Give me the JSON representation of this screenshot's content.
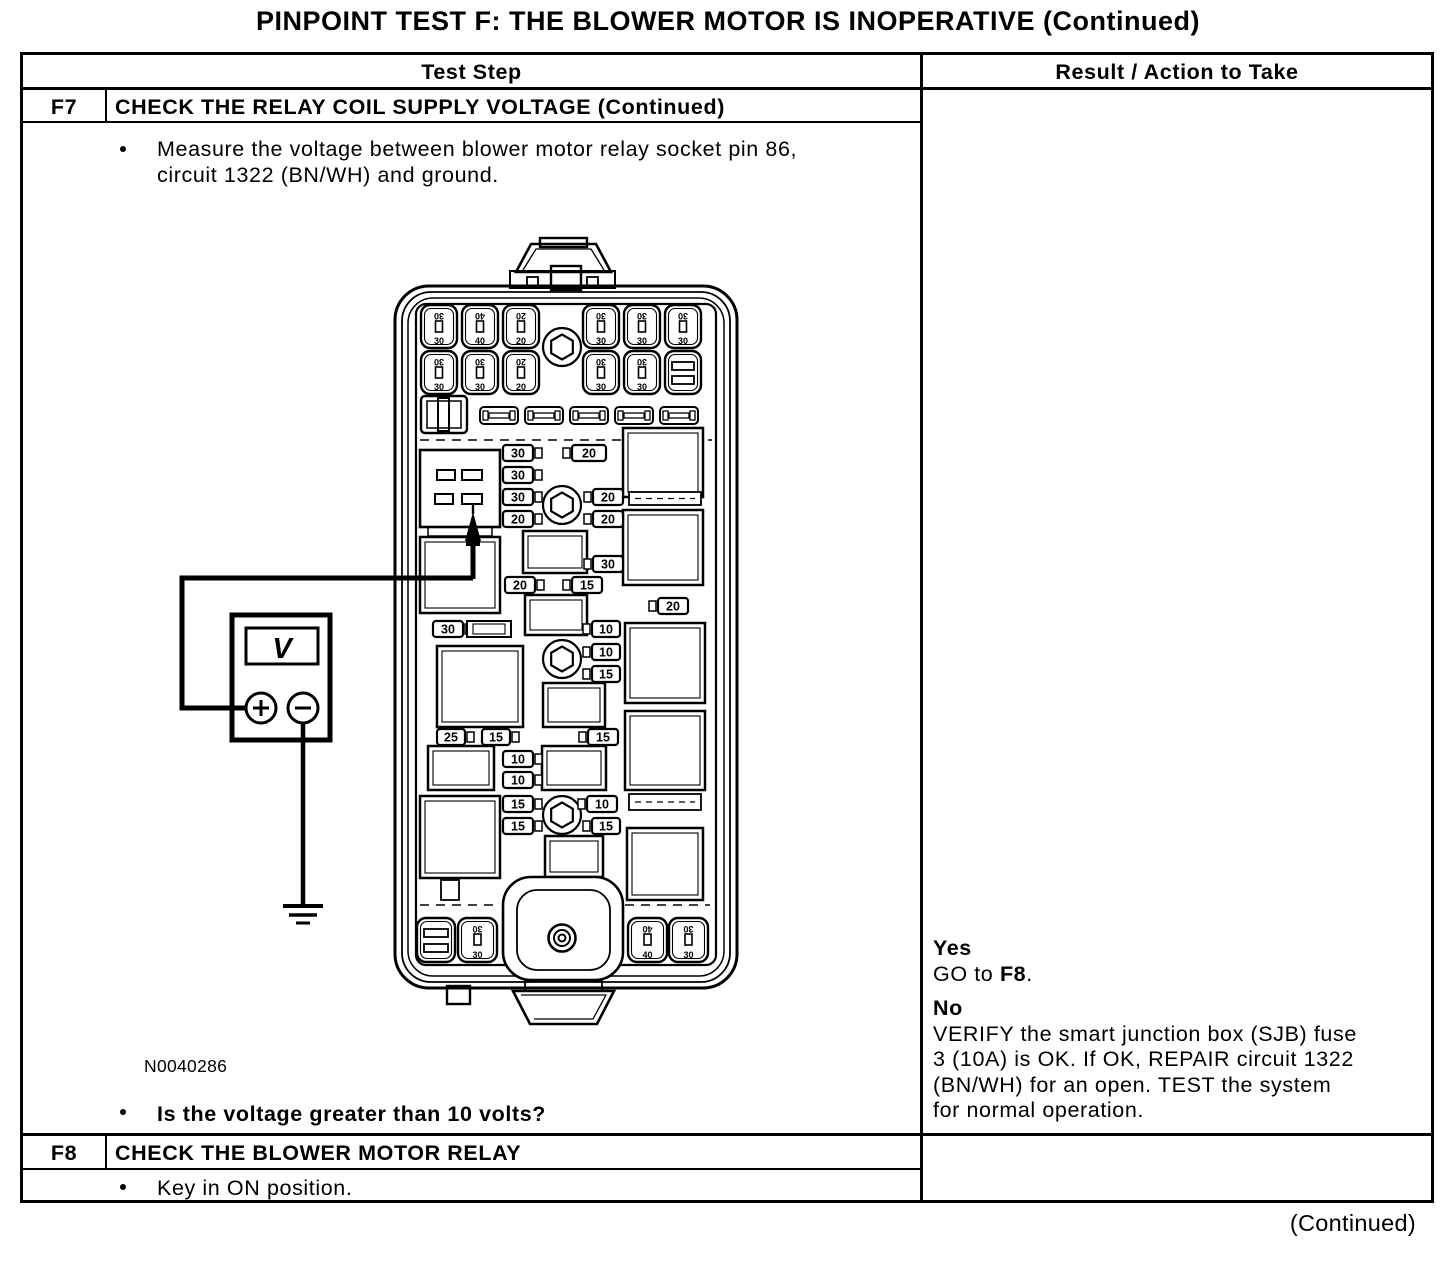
{
  "page_title": "PINPOINT TEST F: THE BLOWER MOTOR IS INOPERATIVE (Continued)",
  "table": {
    "col_headers": {
      "test_step": "Test Step",
      "result": "Result / Action to Take"
    },
    "f7": {
      "id": "F7",
      "title": "CHECK THE RELAY COIL SUPPLY VOLTAGE (Continued)",
      "bullet1_lines": [
        "Measure the voltage between blower motor relay socket pin 86,",
        "circuit 1322 (BN/WH) and ground."
      ],
      "figure_label": "N0040286",
      "bullet2": "Is the voltage greater than 10 volts?",
      "result": {
        "yes_label": "Yes",
        "yes_action": {
          "prefix": "GO to ",
          "bold": "F8",
          "suffix": "."
        },
        "no_label": "No",
        "no_action_lines": [
          "VERIFY the smart junction box (SJB) fuse",
          "3 (10A) is OK. If OK, REPAIR circuit 1322",
          "(BN/WH) for an open. TEST the system",
          "for normal operation."
        ]
      }
    },
    "f8": {
      "id": "F8",
      "title": "CHECK THE BLOWER MOTOR RELAY",
      "bullet1": "Key in ON position."
    }
  },
  "footer": {
    "continued_note": "(Continued)"
  },
  "diagram": {
    "meter_label": "V",
    "big_fuses_top_row1": [
      "30",
      "40",
      "20",
      "30",
      "30",
      "30"
    ],
    "big_fuses_top_row2": [
      "30",
      "30",
      "20",
      "30",
      "30"
    ],
    "big_fuses_bottom": [
      "30",
      "40",
      "30"
    ],
    "mini_fuses": [
      "30",
      "20",
      "30",
      "30",
      "20",
      "20",
      "20",
      "30",
      "20",
      "15",
      "20",
      "30",
      "10",
      "10",
      "15",
      "25",
      "15",
      "15",
      "10",
      "10",
      "15",
      "10",
      "15",
      "15"
    ]
  }
}
